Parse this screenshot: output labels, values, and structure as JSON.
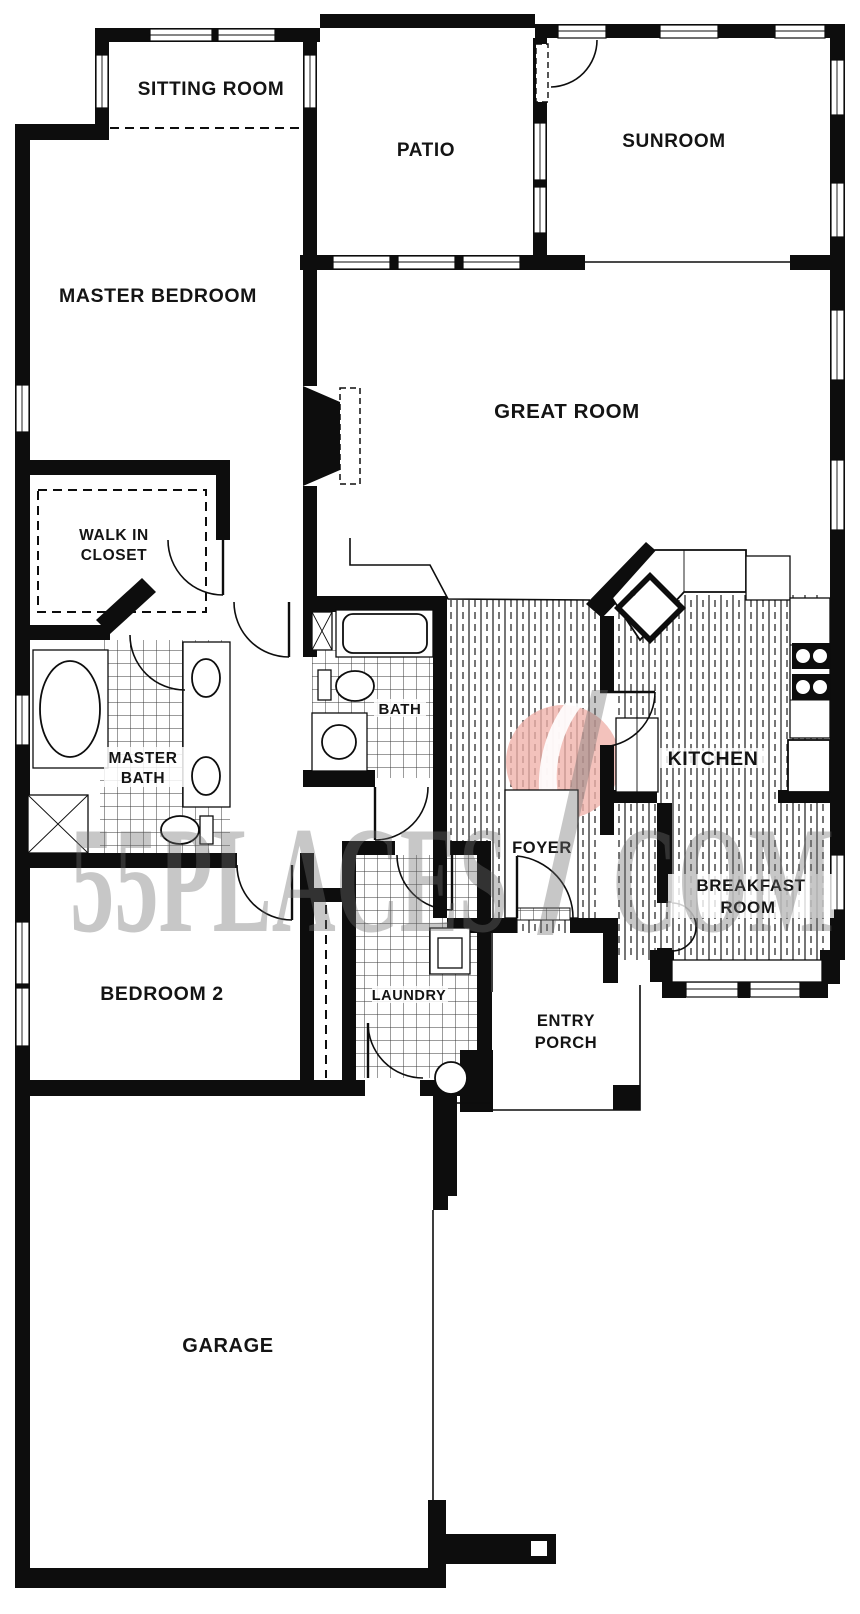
{
  "rooms": {
    "sitting_room": "SITTING ROOM",
    "patio": "PATIO",
    "sunroom": "SUNROOM",
    "master_bedroom": "MASTER BEDROOM",
    "great_room": "GREAT ROOM",
    "walk_in_closet_line1": "WALK IN",
    "walk_in_closet_line2": "CLOSET",
    "master_bath_line1": "MASTER",
    "master_bath_line2": "BATH",
    "bath": "BATH",
    "foyer": "FOYER",
    "kitchen": "KITCHEN",
    "breakfast_line1": "BREAKFAST",
    "breakfast_line2": "ROOM",
    "bedroom2": "BEDROOM 2",
    "laundry": "LAUNDRY",
    "entry_porch_line1": "ENTRY",
    "entry_porch_line2": "PORCH",
    "garage": "GARAGE"
  },
  "watermark": {
    "left": "55PLACES",
    "right": "COM",
    "logo_circle_color": "#efb1a9"
  }
}
